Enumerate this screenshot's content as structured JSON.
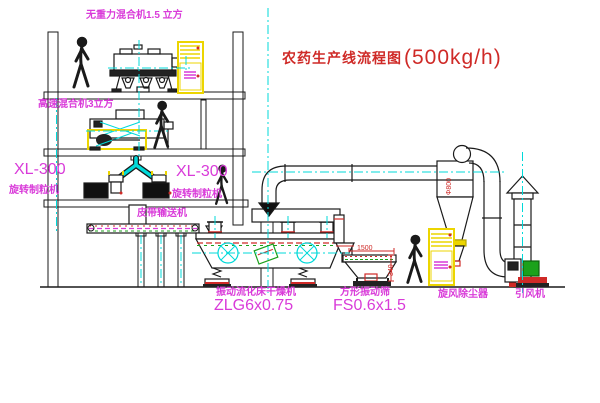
{
  "title": {
    "prefix": "农药生产线流程图",
    "capacity": "(500kg/h)"
  },
  "labels": {
    "top_mixer": "无重力混合机1.5 立方",
    "high_speed_mixer": "高速混合机3立方",
    "granulator_left_model": "XL-300",
    "granulator_left_name": "旋转制粒机",
    "granulator_mid_model": "XL-300",
    "granulator_mid_name": "旋转制粒机",
    "belt_conveyor": "皮带输送机",
    "dryer_name": "振动流化床干燥机",
    "dryer_model": "ZLG6x0.75",
    "screen_name": "方形振动筛",
    "screen_model": "FS0.6x1.5",
    "cyclone": "旋风除尘器",
    "fan": "引风机"
  },
  "dimensions": {
    "screen_length": "1500",
    "screen_height": "340",
    "cyclone_diameter": "Ф800"
  },
  "colors": {
    "line_black": "#1a1a1a",
    "centerline_cyan": "#00d9d9",
    "label_magenta": "#d93bd9",
    "title_red": "#cf2a27",
    "cabinet_yellow": "#ecd500",
    "detail_green": "#1ba11b"
  }
}
